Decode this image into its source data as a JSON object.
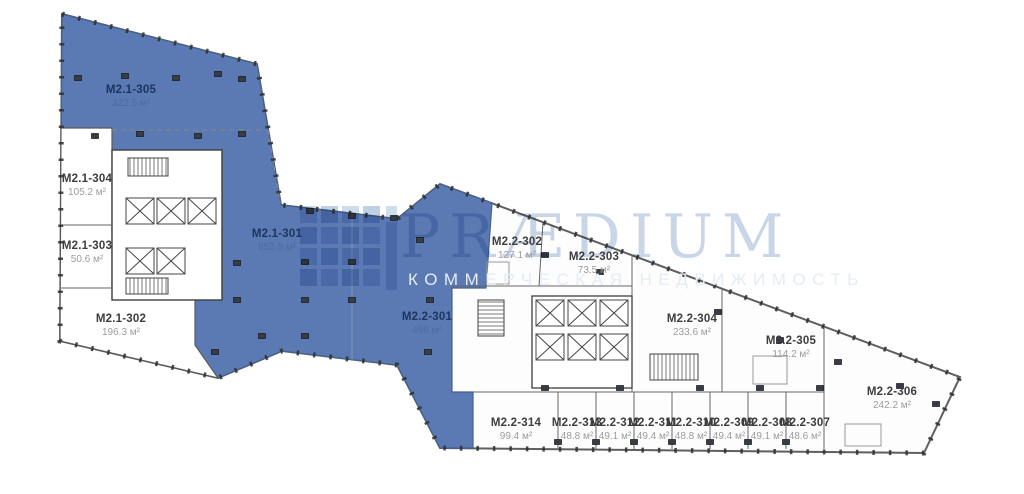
{
  "watermark": {
    "brand": "PRÆDIUM",
    "tagline": "КОММЕРЧЕСКАЯ НЕДВИЖИМОСТЬ"
  },
  "colors": {
    "highlight": "#5b7ab3",
    "highlight_text": "#1e3560",
    "highlight_subtext": "#4a6ba6",
    "unit_text": "#3d3d3d",
    "unit_subtext": "#9c9c9c"
  },
  "units": [
    {
      "label": "M2.1-305",
      "area": "322.5 м²",
      "highlighted": true
    },
    {
      "label": "M2.1-304",
      "area": "105.2 м²",
      "highlighted": false
    },
    {
      "label": "M2.1-303",
      "area": "50.6 м²",
      "highlighted": false
    },
    {
      "label": "M2.1-302",
      "area": "196.3 м²",
      "highlighted": false
    },
    {
      "label": "M2.1-301",
      "area": "853.8 м²",
      "highlighted": true
    },
    {
      "label": "M2.2-301",
      "area": "496 м²",
      "highlighted": true
    },
    {
      "label": "M2.2-302",
      "area": "127.1 м²",
      "highlighted": false
    },
    {
      "label": "M2.2-303",
      "area": "73.5 м²",
      "highlighted": false
    },
    {
      "label": "M2.2-304",
      "area": "233.6 м²",
      "highlighted": false
    },
    {
      "label": "M2.2-305",
      "area": "114.2 м²",
      "highlighted": false
    },
    {
      "label": "M2.2-306",
      "area": "242.2 м²",
      "highlighted": false
    },
    {
      "label": "M2.2-314",
      "area": "99.4 м²",
      "highlighted": false
    },
    {
      "label": "M2.2-313",
      "area": "48.8 м²",
      "highlighted": false
    },
    {
      "label": "M2.2-312",
      "area": "49.1 м²",
      "highlighted": false
    },
    {
      "label": "M2.2-311",
      "area": "49.4 м²",
      "highlighted": false
    },
    {
      "label": "M2.2-310",
      "area": "48.8 м²",
      "highlighted": false
    },
    {
      "label": "M2.2-309",
      "area": "49.4 м²",
      "highlighted": false
    },
    {
      "label": "M2.2-308",
      "area": "49.1 м²",
      "highlighted": false
    },
    {
      "label": "M2.2-307",
      "area": "48.6 м²",
      "highlighted": false
    }
  ]
}
